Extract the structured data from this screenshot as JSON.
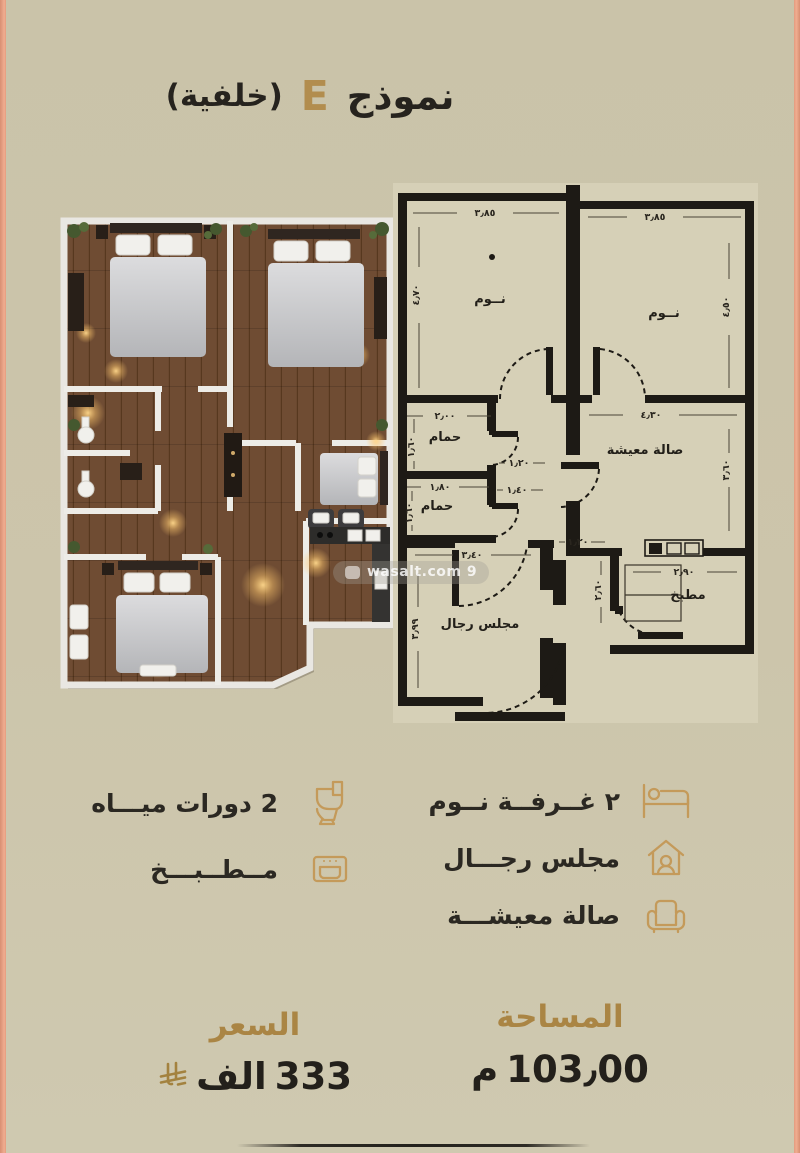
{
  "header": {
    "word": "نموذج",
    "letter": "E",
    "suffix": "(خلفية)"
  },
  "watermark": {
    "text": "wasalt.com 9"
  },
  "plan2d": {
    "rooms": {
      "bedroom1": "نــوم",
      "bedroom2": "نــوم",
      "bath1": "حمام",
      "bath2": "حمام",
      "living": "صالة معيشة",
      "majlis": "مجلس رجال",
      "kitchen": "مطبخ"
    },
    "dims": {
      "bedroom1_w": "٣٫٨٥",
      "bedroom1_h": "٤٫٧٠",
      "bedroom2_w": "٣٫٨٥",
      "bedroom2_h": "٤٫٥٠",
      "bath1_w": "٢٫٠٠",
      "bath1_h": "١٫٦٠",
      "bath2_w": "١٫٨٠",
      "bath2_h": "١٫٦٠",
      "hall_w1": "١٫٢٠",
      "hall_w2": "١٫٤٠",
      "hall_w3": "١٫٢٠",
      "living_w": "٤٫٣٠",
      "living_h": "٣٫٦٠",
      "majlis_w": "٣٫٤٠",
      "majlis_h": "٣٫٩٩",
      "kitchen_w": "٢٫٩٠",
      "kitchen_h": "٢٫٦٠"
    }
  },
  "features": {
    "bathrooms": "2 دورات ميـــاه",
    "kitchen": "مــطــبـــخ",
    "bedrooms": "٢ غــرفــة نــوم",
    "majlis": "مجلس رجـــال",
    "living": "صالة معيشـــة"
  },
  "stats": {
    "area_label": "المساحة",
    "area_value": "103٫00",
    "area_unit": "م",
    "price_label": "السعر",
    "price_value": "333",
    "price_unit": "الف"
  }
}
